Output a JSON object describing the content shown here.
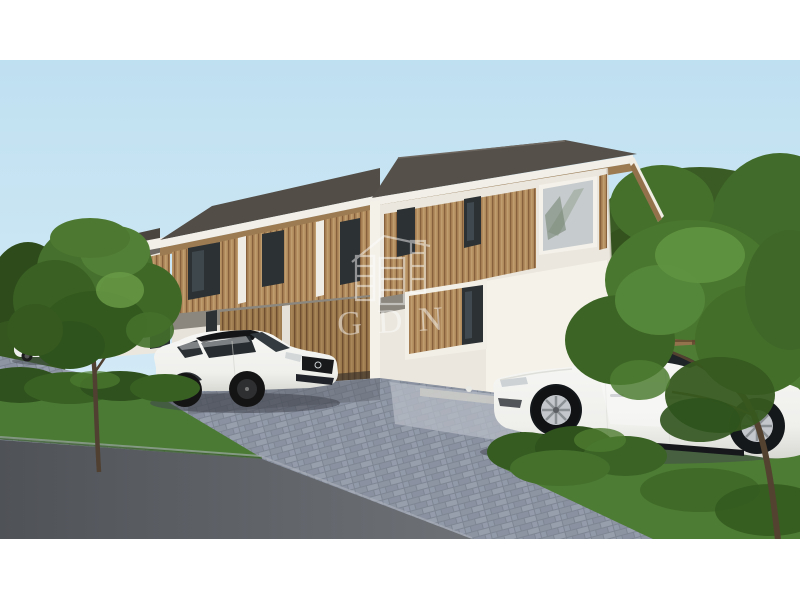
{
  "image": {
    "kind": "architectural-rendering-photo",
    "subject": "Modern two-storey duplex house with vertical wood-slat cladding, grey hip roof, paver driveway, two white cars parked in front, trees on both sides",
    "letterbox_color": "#ffffff"
  },
  "watermark": {
    "text": "GDN",
    "icon": "house-grid-logo-icon",
    "color": "#ffffff",
    "opacity": 0.48
  },
  "palette": {
    "sky_top": "#bfe0f1",
    "sky_bottom": "#e3f2f9",
    "roof": "#544f48",
    "fascia": "#f2efe8",
    "soffit_wood": "#9d7b52",
    "wall_lit": "#f5f2ea",
    "wall_shaded": "#e9e4db",
    "wood_slats": "#b08a5c",
    "floor_band": "#8b867e",
    "window_glass_dark": "#2c3133",
    "corner_window_glass": "#c6cbcd",
    "paver": "#8f96a4",
    "paver_light": "#b6bbc4",
    "asphalt": "#5f6267",
    "grass": "#4b7a35",
    "foliage_dark": "#35571f",
    "foliage_mid": "#4a7530",
    "foliage_light": "#629441",
    "fence_wood": "#93724e",
    "car_white": "#f2f2ef"
  },
  "scene_objects": [
    "sky",
    "background-trees",
    "wooden-fence",
    "duplex-house",
    "hip-roof",
    "wood-slat-facade",
    "upstairs-windows",
    "corner-window",
    "ground-floor-window",
    "carport-slat-screen",
    "paver-driveway",
    "asphalt-road",
    "grass-strips",
    "hedge-bushes",
    "left-tree",
    "right-tree",
    "white-coupe-car",
    "white-sedan-car",
    "distant-parked-car",
    "gdn-watermark"
  ]
}
